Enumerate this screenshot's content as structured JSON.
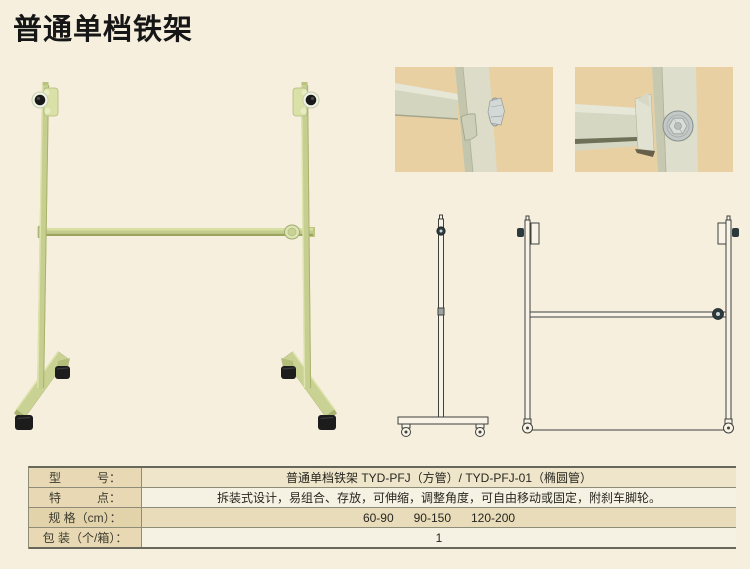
{
  "page": {
    "title": "普通单档铁架"
  },
  "images": {
    "main_photo": "product-stand-photo",
    "detail_photo_1": "crossbar-joint-closeup",
    "detail_photo_2": "bracket-bolt-closeup",
    "drawing_side": "stand-side-view-drawing",
    "drawing_front": "stand-front-view-drawing"
  },
  "colors": {
    "page_bg": "#f6efde",
    "title": "#161616",
    "frame_green": "#c6cf90",
    "caster_black": "#1d1d1d",
    "detail_photo_bg": "#e9d0a2",
    "detail_metal": "#dcdcc9",
    "table_label_bg": "#e8d9b4",
    "table_row_tint": "#e9dcbb",
    "table_row_light": "#f6f2e3",
    "table_border": "#8c8c78",
    "drawing_stroke": "#3d423e"
  },
  "spec_table": {
    "rows": [
      {
        "label": "型　　　号：",
        "value": "普通单档铁架 TYD-PFJ（方管）/ TYD-PFJ-01（椭圆管）"
      },
      {
        "label": "特　　　点：",
        "value": "拆装式设计，易组合、存放，可伸缩，调整角度，可自由移动或固定，附刹车脚轮。"
      },
      {
        "label": "规 格（cm）：",
        "value": "60-90      90-150      120-200"
      },
      {
        "label": "包 装（个/箱）：",
        "value": "1"
      }
    ]
  }
}
